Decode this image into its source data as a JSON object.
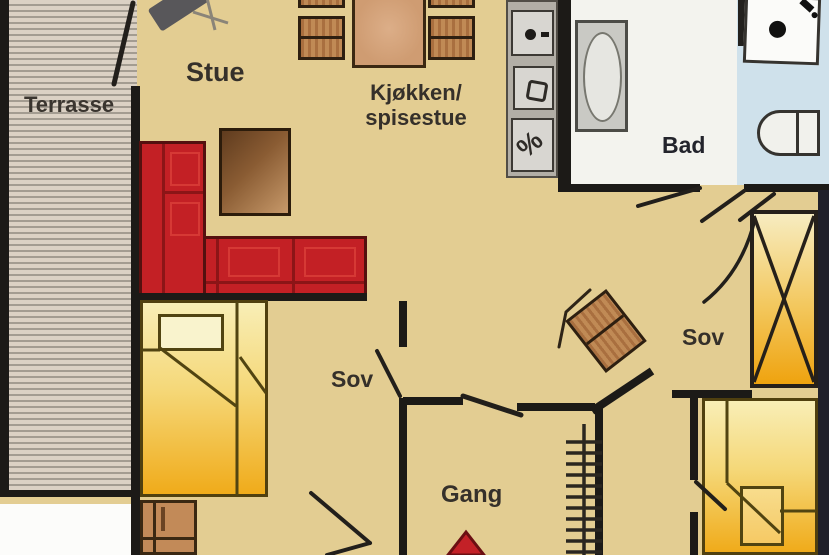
{
  "plan": {
    "title": "Hytteplan / cabin floor plan",
    "rooms": {
      "terrace": {
        "label": "Terrasse"
      },
      "living": {
        "label": "Stue"
      },
      "kitchen": {
        "label_line1": "Kjøkken/",
        "label_line2": "spisestue"
      },
      "bath": {
        "label": "Bad"
      },
      "bedroom_right": {
        "label": "Sov"
      },
      "bedroom_left": {
        "label": "Sov"
      },
      "hall": {
        "label": "Gang"
      }
    },
    "appliances": {
      "dishwasher_symbol": "%"
    },
    "icons": [
      "sofa",
      "coffee-table",
      "wood-stove",
      "dining-table",
      "chair",
      "cooktop",
      "sink",
      "dishwasher",
      "bathtub",
      "shower",
      "toilet",
      "wardrobe",
      "bed",
      "dresser",
      "ladder",
      "entrance-arrow"
    ],
    "colors": {
      "floor": "#e3cd92",
      "wall": "#1c1a17",
      "sofa_red": "#c32025",
      "bed_yellow": "#f0ab1a",
      "wood_brown": "#b97e4e",
      "bath_blue": "#cfe1eb",
      "arrow_red": "#c32127"
    }
  }
}
